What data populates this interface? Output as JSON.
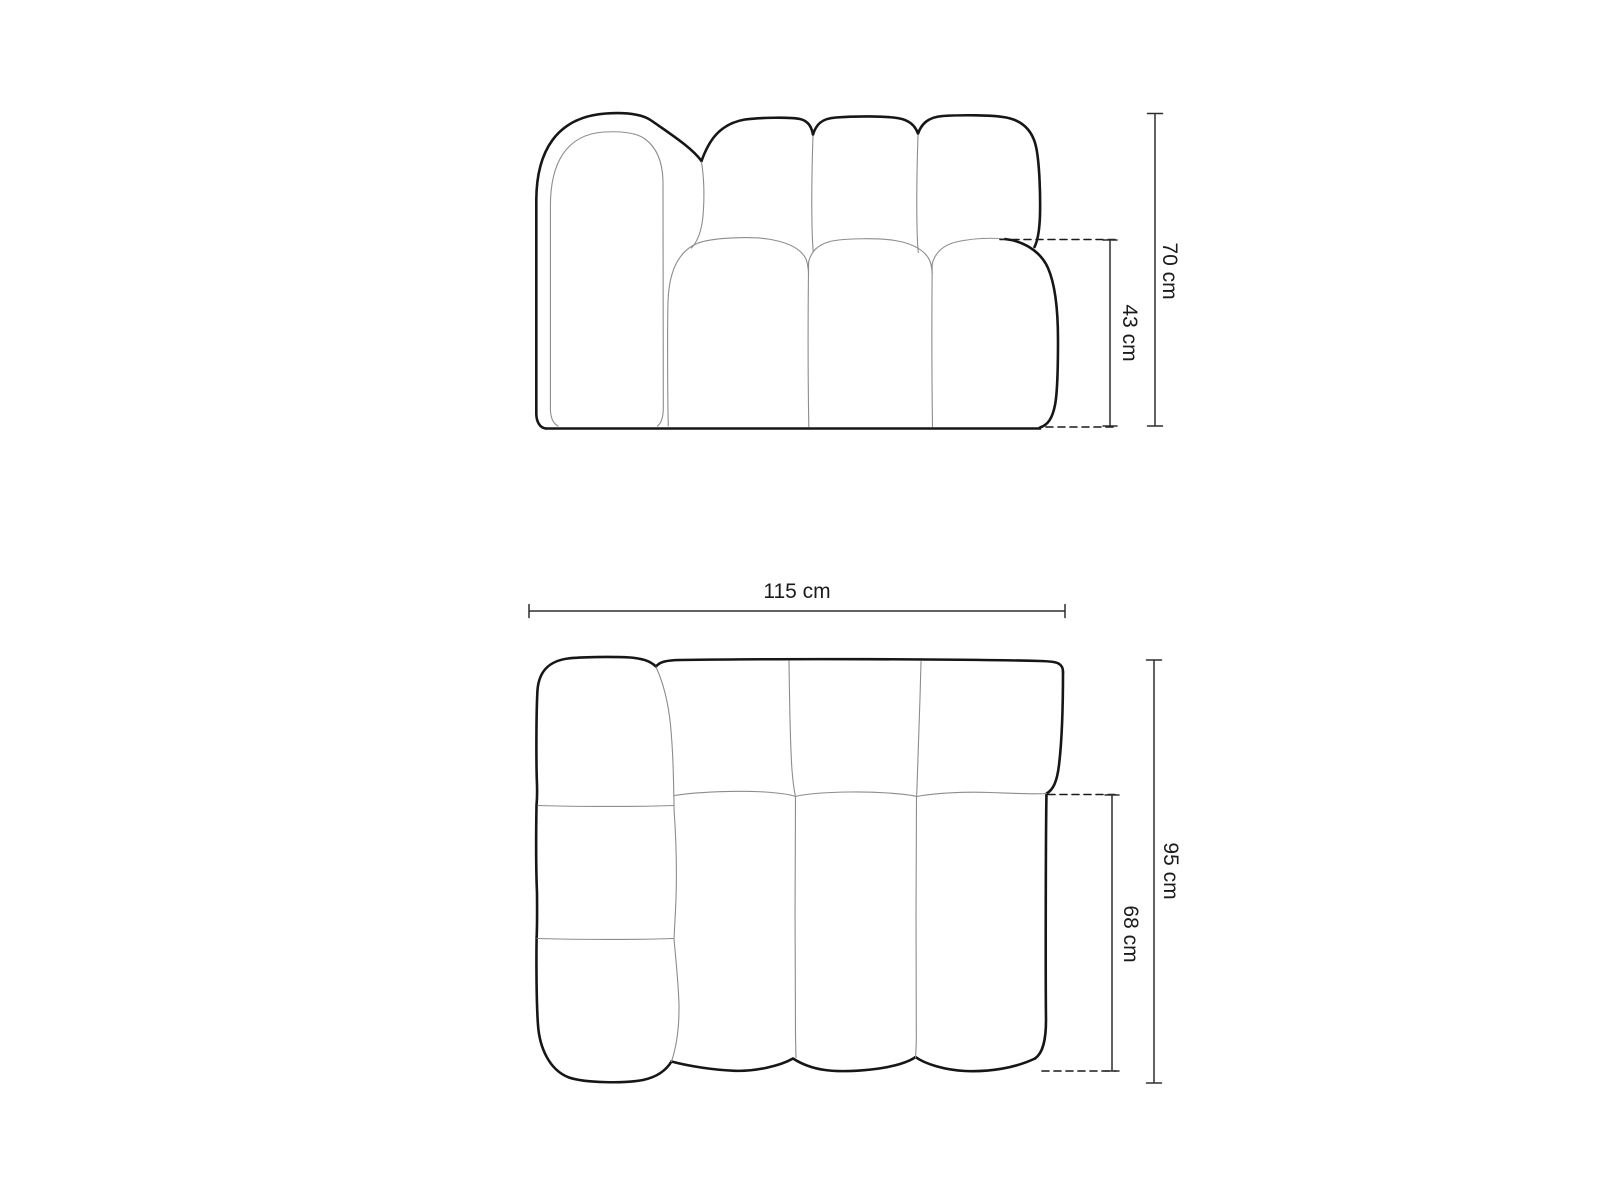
{
  "figure": {
    "front_view": {
      "height_label": "70 cm",
      "seat_height_label": "43 cm"
    },
    "top_view": {
      "width_label": "115 cm",
      "depth_label": "95 cm",
      "seat_depth_label": "68 cm"
    },
    "colors": {
      "outline": "#161616",
      "thin_line": "#8c8c8c",
      "dimension": "#2e2e2e",
      "dashed": "#1a1a1a",
      "background": "#ffffff"
    }
  }
}
